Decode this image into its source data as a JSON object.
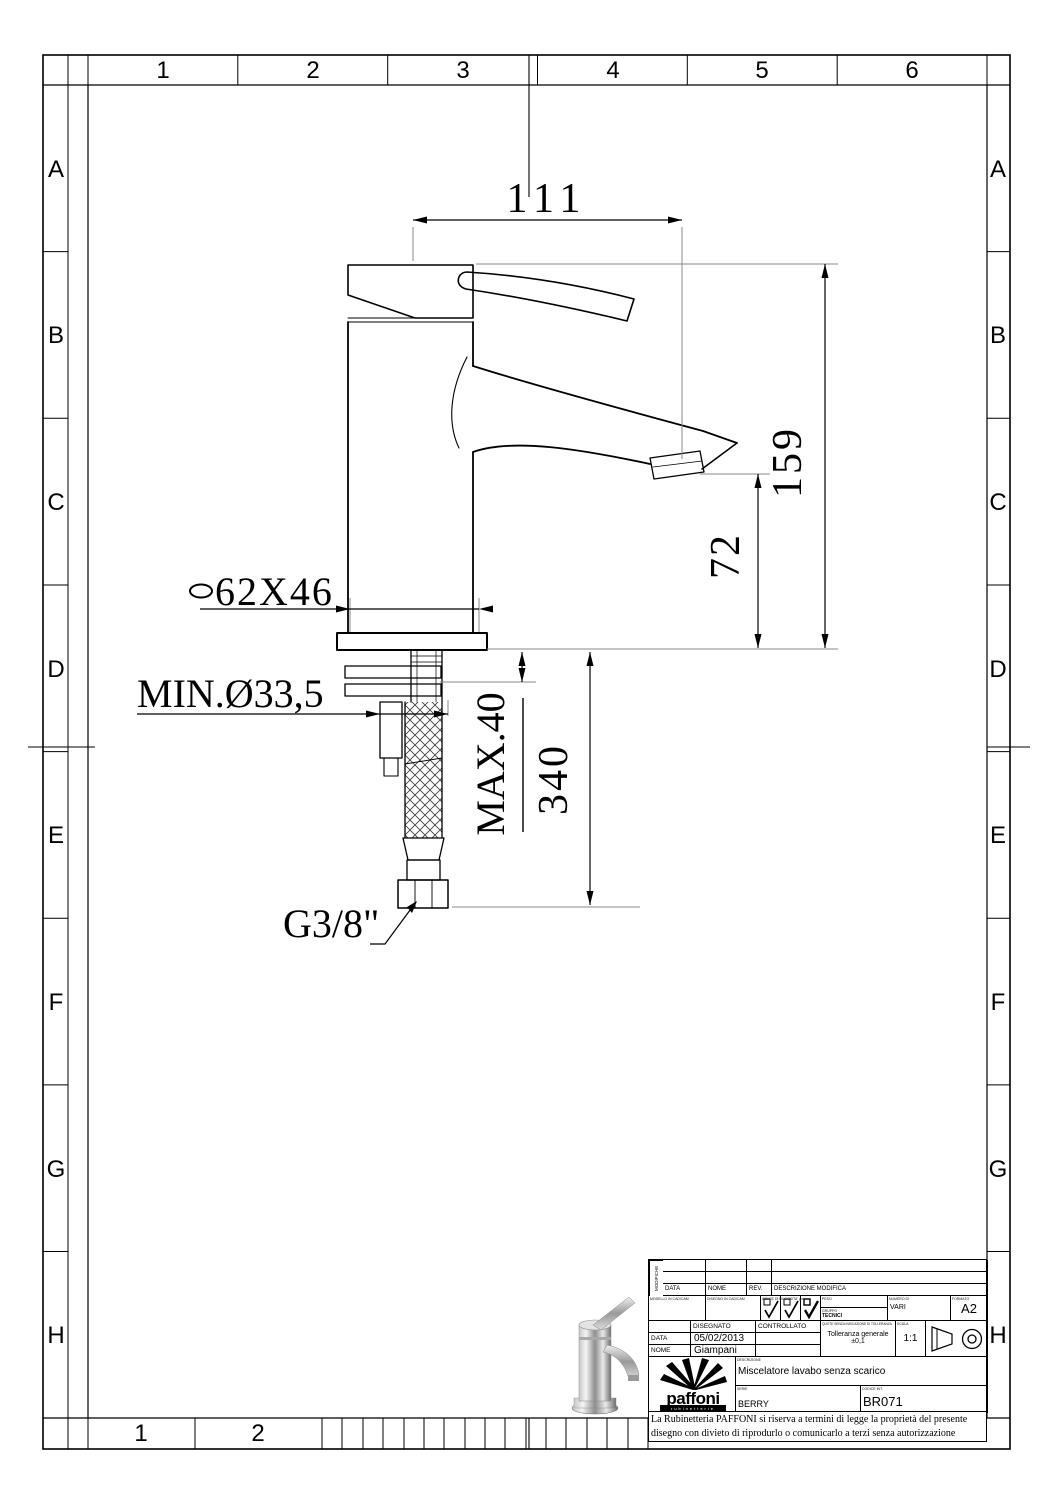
{
  "frame": {
    "top_cols": [
      "1",
      "2",
      "3",
      "4",
      "5",
      "6"
    ],
    "side_rows": [
      "A",
      "B",
      "C",
      "D",
      "E",
      "F",
      "G",
      "H"
    ],
    "bottom_cols": [
      "1",
      "2"
    ]
  },
  "dimensions": {
    "spout_reach": "111",
    "total_height": "159",
    "outlet_height": "72",
    "base_size": "62X46",
    "min_hole": "MIN.Ø33,5",
    "max_deck": "MAX.40",
    "hose_length": "340",
    "connection": "G3/8\""
  },
  "title_block": {
    "modifiche": "MODIFICHE",
    "rev_headers": {
      "data": "DATA",
      "nome": "NOME",
      "rev": "REV.",
      "descr": "DESCRIZIONE MODIFICA"
    },
    "micro_cell1": "MODELLO IN CAD/CAM",
    "micro_cell2": "DISEGNO IN CAD/CAM",
    "rugosita_label": "INDICE DI RUGOSITA' µm",
    "peso_label": "PESO",
    "gruppo_label": "GRUPPO",
    "gruppo_value": "TECNICI",
    "numero_label": "NUMERO DI",
    "numero_value": "VARI",
    "formato_label": "FORMATO",
    "formato_value": "A2",
    "disegnato_label": "DISEGNATO",
    "controllato_label": "CONTROLLATO",
    "data_label": "DATA",
    "data_value": "05/02/2013",
    "nome_label": "NOME",
    "nome_value": "Giampani",
    "toll_label": "QUOTE SENZA INDICAZIONE DI TOLLERANZA",
    "toll_value": "Tolleranza generale ±0,1",
    "scala_label": "SCALA",
    "scala_value": "1:1",
    "descr_label": "DESCRIZIONE",
    "descr_value": "Miscelatore lavabo senza scarico",
    "serie_label": "SERIE",
    "serie_value": "BERRY",
    "codice_label": "CODICE INT.",
    "codice_value": "BR071",
    "logo_text": "paffoni",
    "logo_sub": "rubinetterie",
    "disclaimer1": "La Rubinetteria PAFFONI si riserva a termini di legge la proprietà del presente",
    "disclaimer2": "disegno con divieto di riprodurlo o comunicarlo a terzi senza autorizzazione"
  }
}
